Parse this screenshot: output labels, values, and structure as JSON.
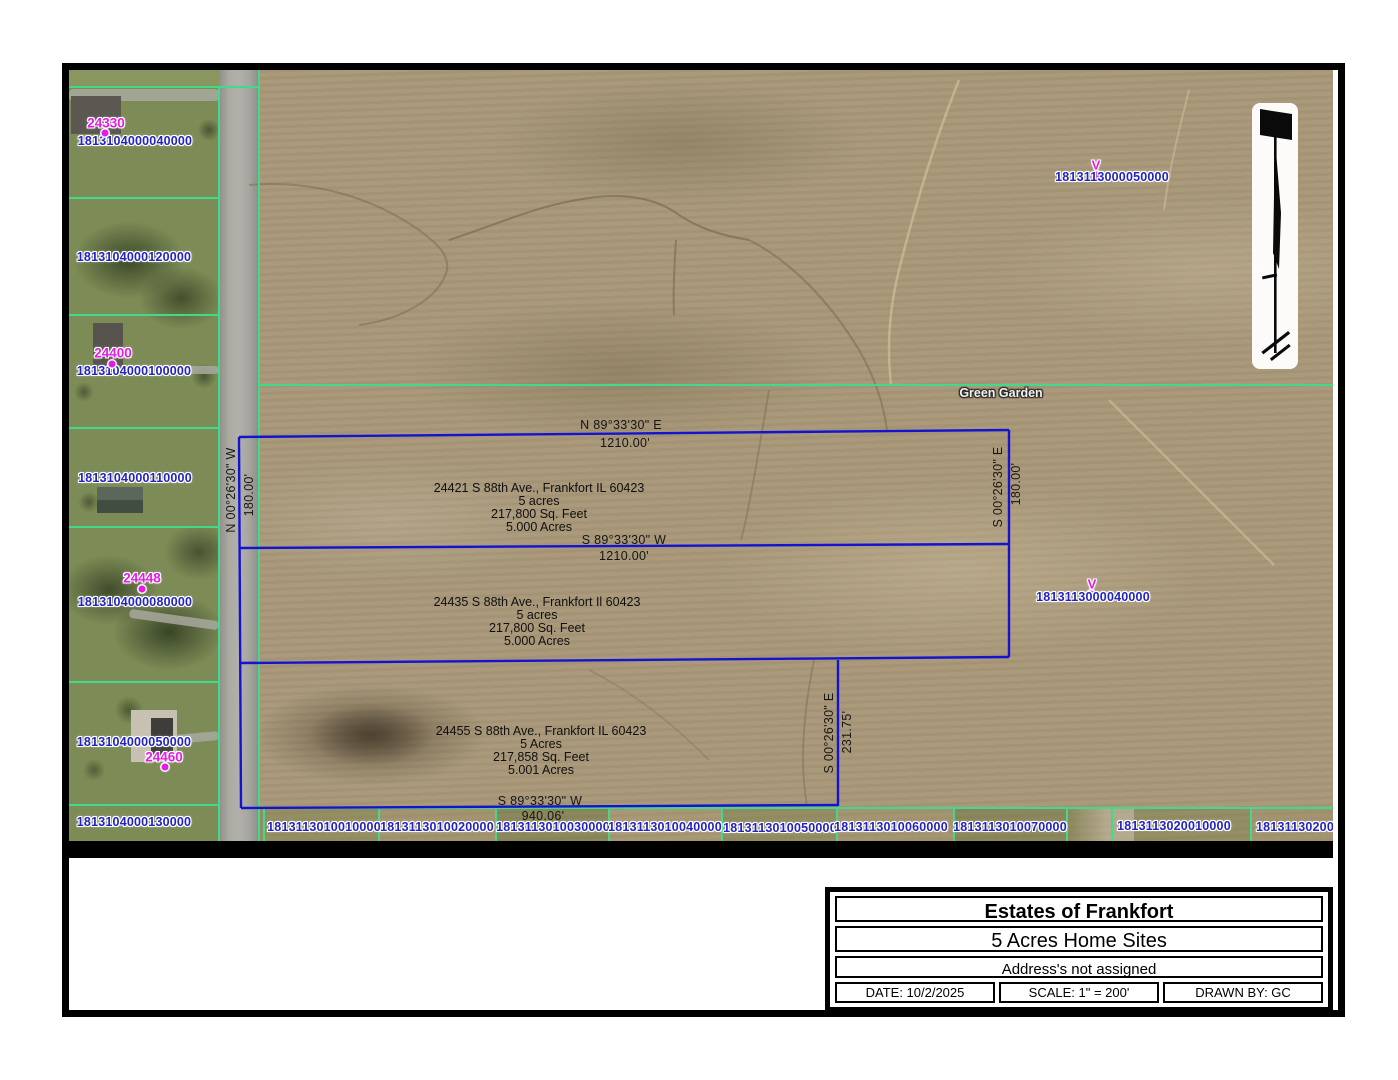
{
  "title_block": {
    "title": "Estates of Frankfort",
    "subtitle": "5 Acres Home Sites",
    "note": "Address's not assigned",
    "date": "DATE: 10/2/2025",
    "scale": "SCALE: 1\" = 200'",
    "drawn_by": "DRAWN BY: GC"
  },
  "map": {
    "area_label": "Green Garden",
    "marker_glyph": "V",
    "left_parcel_ids": [
      {
        "id": "1813104000040000",
        "x": 66,
        "y": 71
      },
      {
        "id": "1813104000120000",
        "x": 65,
        "y": 187
      },
      {
        "id": "1813104000100000",
        "x": 65,
        "y": 301
      },
      {
        "id": "1813104000110000",
        "x": 66,
        "y": 408
      },
      {
        "id": "1813104000080000",
        "x": 66,
        "y": 532
      },
      {
        "id": "1813104000050000",
        "x": 65,
        "y": 672
      },
      {
        "id": "1813104000130000",
        "x": 65,
        "y": 752
      }
    ],
    "house_numbers": [
      {
        "num": "24330",
        "x": 37,
        "y": 53,
        "dx": 36,
        "dy": 63
      },
      {
        "num": "24400",
        "x": 44,
        "y": 283,
        "dx": 43,
        "dy": 294
      },
      {
        "num": "24448",
        "x": 73,
        "y": 508,
        "dx": 73,
        "dy": 519
      },
      {
        "num": "24460",
        "x": 95,
        "y": 687,
        "dx": 96,
        "dy": 697
      }
    ],
    "v_markers": [
      {
        "id": "1813113000050000",
        "x": 1043,
        "y": 107,
        "vx": 1027,
        "vy": 95,
        "dx": 1028,
        "dy": 105
      },
      {
        "id": "1813113000040000",
        "x": 1024,
        "y": 527,
        "vx": 1023,
        "vy": 514,
        "dx": 1022,
        "dy": 524
      }
    ],
    "bottom_parcel_ids": [
      {
        "id": "1813113010010000",
        "x": 255,
        "y": 757
      },
      {
        "id": "1813113010020000",
        "x": 368,
        "y": 757
      },
      {
        "id": "1813113010030000",
        "x": 484,
        "y": 757
      },
      {
        "id": "1813113010040000",
        "x": 596,
        "y": 757
      },
      {
        "id": "1813113010050000",
        "x": 711,
        "y": 758
      },
      {
        "id": "1813113010060000",
        "x": 822,
        "y": 757
      },
      {
        "id": "1813113010070000",
        "x": 941,
        "y": 757
      },
      {
        "id": "1813113020010000",
        "x": 1105,
        "y": 756
      },
      {
        "id": "18131130200",
        "x": 1226,
        "y": 757
      }
    ],
    "bearings": [
      {
        "t": "N 89°33'30\" E",
        "x": 552,
        "y": 355,
        "rot": 0
      },
      {
        "t": "1210.00'",
        "x": 556,
        "y": 373,
        "rot": 0
      },
      {
        "t": "S 89°33'30\" W",
        "x": 555,
        "y": 470,
        "rot": 0
      },
      {
        "t": "1210.00'",
        "x": 555,
        "y": 486,
        "rot": 0
      },
      {
        "t": "S 89°33'30\" W",
        "x": 471,
        "y": 731,
        "rot": 0
      },
      {
        "t": "940.06'",
        "x": 474,
        "y": 746,
        "rot": 0
      },
      {
        "t": "N 00°26'30\" W",
        "x": 162,
        "y": 420,
        "rot": -90
      },
      {
        "t": "180.00'",
        "x": 180,
        "y": 425,
        "rot": -90
      },
      {
        "t": "S 00°26'30\" E",
        "x": 929,
        "y": 417,
        "rot": -90
      },
      {
        "t": "180.00'",
        "x": 947,
        "y": 414,
        "rot": -90
      },
      {
        "t": "S 00°26'30\" E",
        "x": 760,
        "y": 663,
        "rot": -90
      },
      {
        "t": "231.75'",
        "x": 778,
        "y": 662,
        "rot": -90
      }
    ],
    "lot_blocks": [
      {
        "x": 470,
        "y": 412,
        "lines": [
          "24421 S 88th Ave., Frankfort IL 60423",
          "5 acres",
          "217,800 Sq. Feet",
          "5.000 Acres"
        ]
      },
      {
        "x": 468,
        "y": 526,
        "lines": [
          "24435 S 88th Ave., Frankfort Il 60423",
          "5 acres",
          "217,800 Sq. Feet",
          "5.000 Acres"
        ]
      },
      {
        "x": 472,
        "y": 655,
        "lines": [
          "24455 S 88th Ave., Frankfort IL 60423",
          "5 Acres",
          "217,858 Sq. Feet",
          "5.001 Acres"
        ]
      }
    ]
  },
  "colors": {
    "boundary_blue": "#1414d0",
    "lot_line_green": "#41d98b",
    "parcel_id_blue": "#2323bd",
    "house_number_magenta": "#e619e6",
    "dimension_text": "#161616"
  }
}
